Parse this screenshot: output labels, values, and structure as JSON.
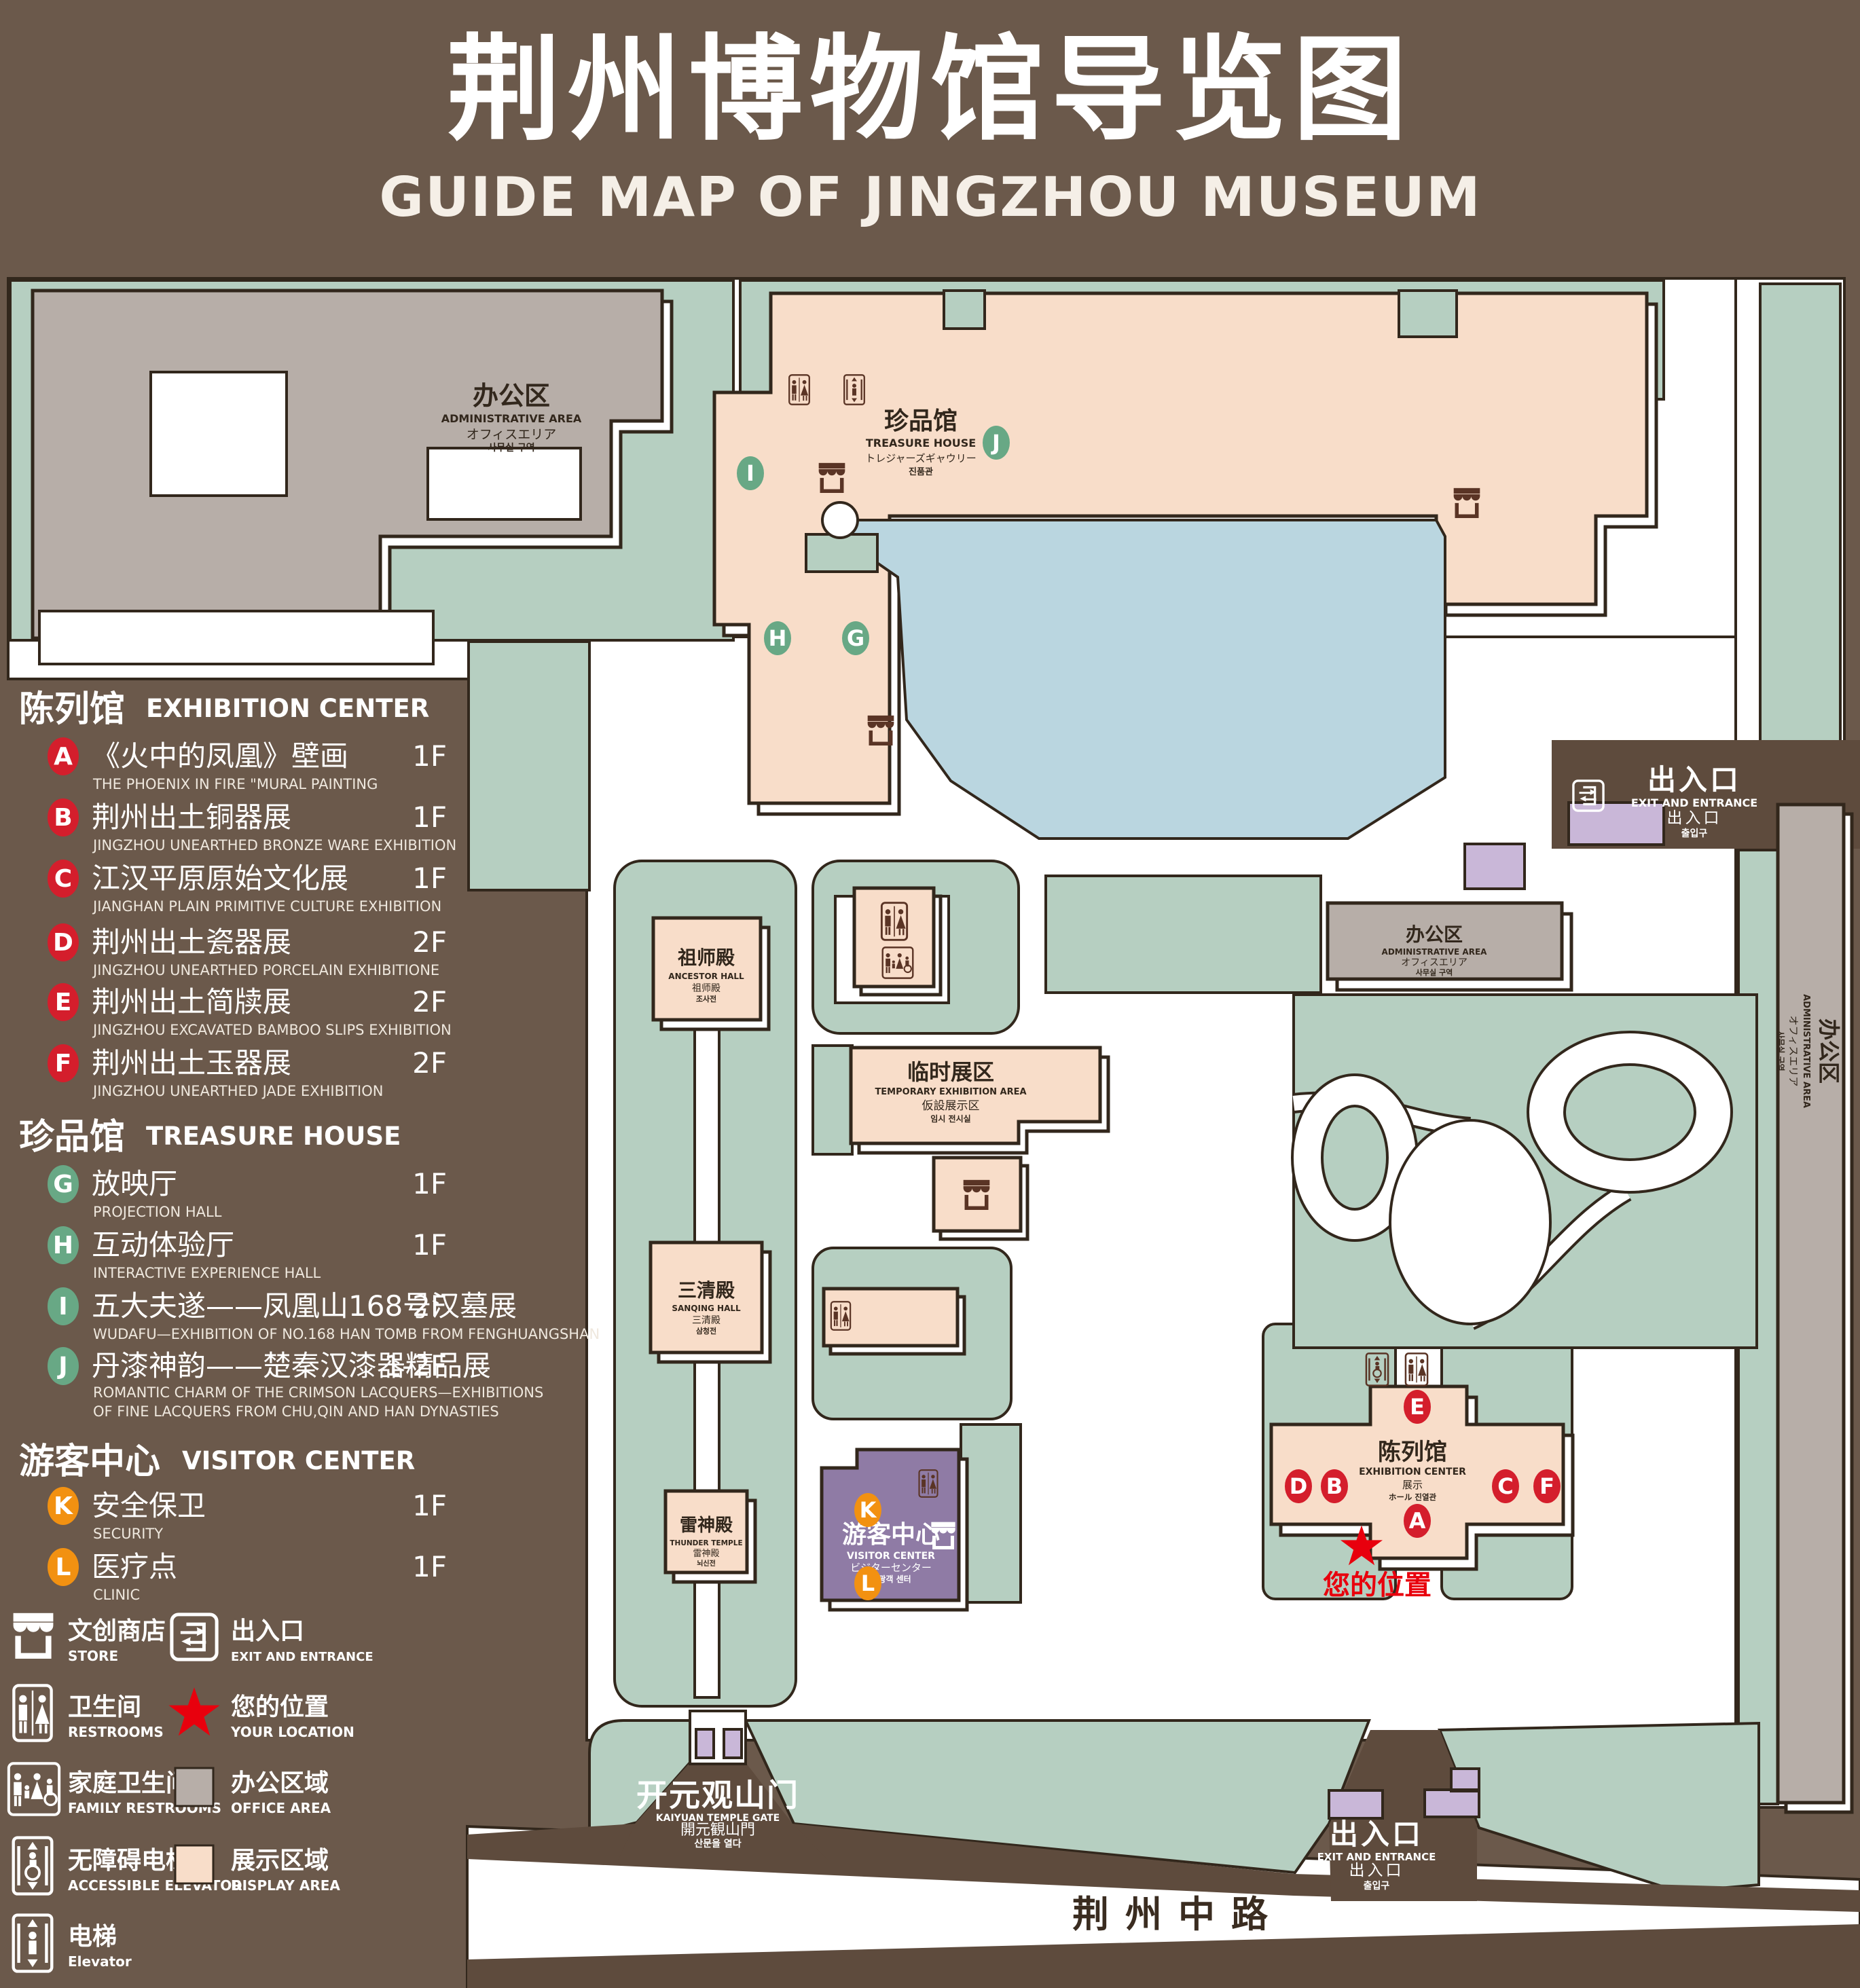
{
  "title": {
    "cn": "荆州博物馆导览图",
    "en": "GUIDE MAP OF JINGZHOU MUSEUM"
  },
  "colors": {
    "poster_brown": "#6B594B",
    "lawn_green": "#B6CFC1",
    "display_area_pink": "#F8DDC9",
    "office_area_gray": "#B7AEA8",
    "pond_blue": "#BAD6E0",
    "visitor_purple": "#8F7BA5",
    "gate_purple": "#C9B7D8",
    "marker_red": "#D41E2C",
    "marker_green": "#68A885",
    "marker_orange": "#F29111",
    "star_red": "#E8000D",
    "wall_brown": "#5E4B3D"
  },
  "legend": {
    "sections": [
      {
        "cn": "陈列馆",
        "en": "EXHIBITION CENTER",
        "items": [
          {
            "letter": "A",
            "cn": "《火中的凤凰》壁画",
            "en": "THE PHOENIX IN FIRE \"MURAL PAINTING",
            "floor": "1F"
          },
          {
            "letter": "B",
            "cn": "荆州出土铜器展",
            "en": "JINGZHOU UNEARTHED BRONZE WARE EXHIBITION",
            "floor": "1F"
          },
          {
            "letter": "C",
            "cn": "江汉平原原始文化展",
            "en": "JIANGHAN PLAIN PRIMITIVE CULTURE EXHIBITION",
            "floor": "1F"
          },
          {
            "letter": "D",
            "cn": "荆州出土瓷器展",
            "en": "JINGZHOU UNEARTHED PORCELAIN EXHIBITIONE",
            "floor": "2F"
          },
          {
            "letter": "E",
            "cn": "荆州出土简牍展",
            "en": "JINGZHOU EXCAVATED BAMBOO SLIPS EXHIBITION",
            "floor": "2F"
          },
          {
            "letter": "F",
            "cn": "荆州出土玉器展",
            "en": "JINGZHOU UNEARTHED JADE EXHIBITION",
            "floor": "2F"
          }
        ]
      },
      {
        "cn": "珍品馆",
        "en": "TREASURE HOUSE",
        "items": [
          {
            "letter": "G",
            "cn": "放映厅",
            "en": "PROJECTION HALL",
            "floor": "1F"
          },
          {
            "letter": "H",
            "cn": "互动体验厅",
            "en": "INTERACTIVE EXPERIENCE HALL",
            "floor": "1F"
          },
          {
            "letter": "I",
            "cn": "五大夫遂——凤凰山168号汉墓展",
            "en": "WUDAFU—EXHIBITION OF NO.168 HAN TOMB FROM FENGHUANGSHAN",
            "floor": "2F"
          },
          {
            "letter": "J",
            "cn": "丹漆神韵——楚秦汉漆器精品展",
            "en": "ROMANTIC CHARM OF THE CRIMSON LACQUERS—EXHIBITIONS",
            "en2": "OF FINE LACQUERS FROM CHU,QIN AND HAN DYNASTIES",
            "floor": "1-2F"
          }
        ]
      },
      {
        "cn": "游客中心",
        "en": "VISITOR CENTER",
        "items": [
          {
            "letter": "K",
            "cn": "安全保卫",
            "en": "SECURITY",
            "floor": "1F"
          },
          {
            "letter": "L",
            "cn": "医疗点",
            "en": "CLINIC",
            "floor": "1F"
          }
        ]
      }
    ],
    "symbols": {
      "store": {
        "cn": "文创商店",
        "en": "STORE"
      },
      "exit": {
        "cn": "出入口",
        "en": "EXIT AND ENTRANCE"
      },
      "restrooms": {
        "cn": "卫生间",
        "en": "RESTROOMS"
      },
      "location": {
        "cn": "您的位置",
        "en": "YOUR LOCATION"
      },
      "family": {
        "cn": "家庭卫生间",
        "en": "FAMILY RESTROOMS"
      },
      "office": {
        "cn": "办公区域",
        "en": "OFFICE AREA"
      },
      "accessible": {
        "cn": "无障碍电梯",
        "en": "ACCESSIBLE ELEVATOR"
      },
      "display": {
        "cn": "展示区域",
        "en": "DISPLAY AREA"
      },
      "elevator": {
        "cn": "电梯",
        "en": "Elevator"
      }
    }
  },
  "map": {
    "admin": {
      "cn": "办公区",
      "en": "ADMINISTRATIVE AREA",
      "jp": "オフィスエリア",
      "kr": "사무실 구역"
    },
    "treasure": {
      "cn": "珍品馆",
      "en": "TREASURE HOUSE",
      "jp": "トレジャーズギャウリー",
      "kr": "진품관"
    },
    "ancestor": {
      "cn": "祖师殿",
      "en": "ANCESTOR HALL",
      "jp": "祖师殿",
      "kr": "조사전"
    },
    "temporary": {
      "cn": "临时展区",
      "en": "TEMPORARY EXHIBITION AREA",
      "jp": "仮設展示区",
      "kr": "임시 전시실"
    },
    "sanqing": {
      "cn": "三清殿",
      "en": "SANQING HALL",
      "jp": "三清殿",
      "kr": "삼청전"
    },
    "thunder": {
      "cn": "雷神殿",
      "en": "THUNDER TEMPLE",
      "jp": "雷神殿",
      "kr": "뇌신전"
    },
    "visitor": {
      "cn": "游客中心",
      "en": "VISITOR CENTER",
      "jp": "ビジターセンター",
      "kr": "관광객 센터"
    },
    "exhibition": {
      "cn": "陈列馆",
      "en": "EXHIBITION CENTER",
      "jp": "展示",
      "kr": "ホール 진열관"
    },
    "gate": {
      "cn": "开元观山门",
      "en": "KAIYUAN TEMPLE GATE",
      "jp": "開元観山門",
      "kr": "산문을 열다"
    },
    "exit": {
      "cn": "出入口",
      "en": "EXIT AND ENTRANCE",
      "jp": "出入口",
      "kr": "출입구"
    },
    "road": "荆州中路",
    "your_location": "您的位置",
    "markers": [
      "A",
      "B",
      "C",
      "D",
      "E",
      "F",
      "G",
      "H",
      "I",
      "J",
      "K",
      "L"
    ]
  }
}
